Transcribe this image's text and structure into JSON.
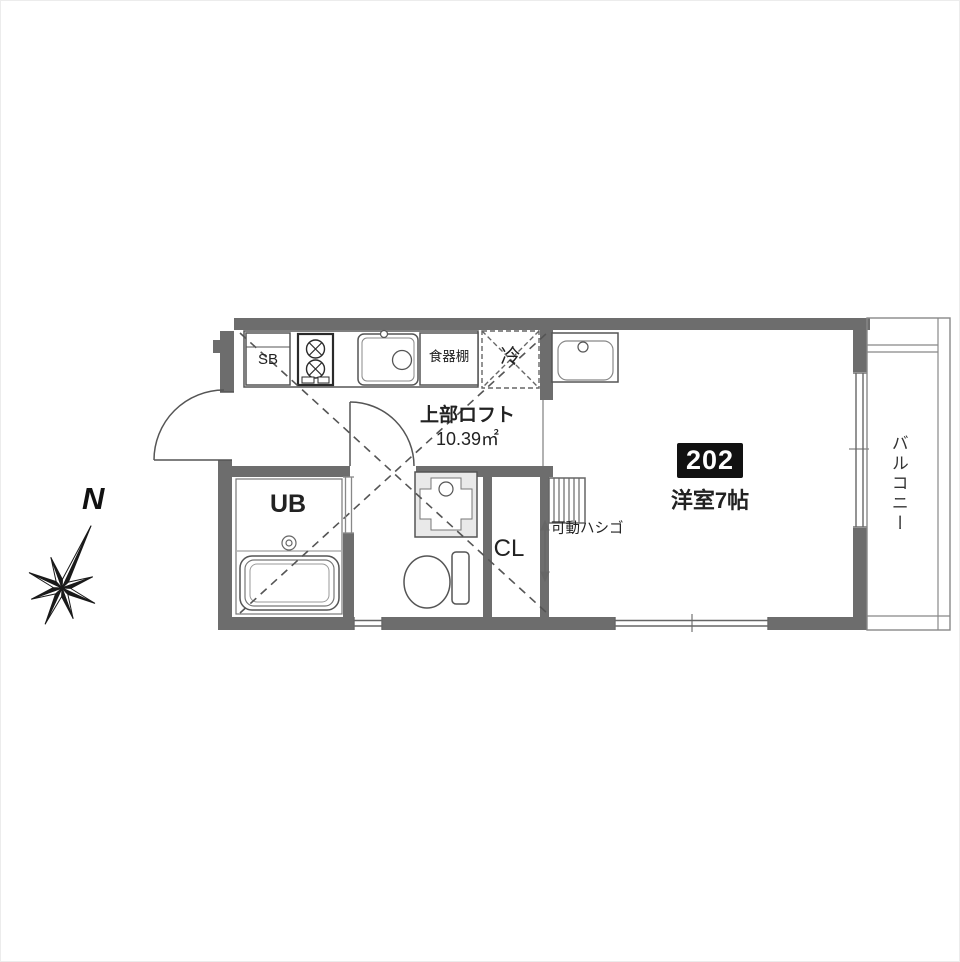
{
  "floorplan": {
    "unit_badge": "202",
    "labels": {
      "shoe_box": "SB",
      "cupboard": "食器棚",
      "refrigerator": "冷",
      "loft_line1": "上部ロフト",
      "loft_line2": "10.39㎡",
      "unit_bath": "UB",
      "closet": "CL",
      "movable_ladder": "可動ハシゴ",
      "western_room": "洋室7帖",
      "balcony": "バルコニー",
      "north": "N"
    },
    "colors": {
      "wall": "#6d6d6d",
      "line": "#555555",
      "badge_bg": "#111111",
      "badge_text": "#ffffff"
    }
  }
}
